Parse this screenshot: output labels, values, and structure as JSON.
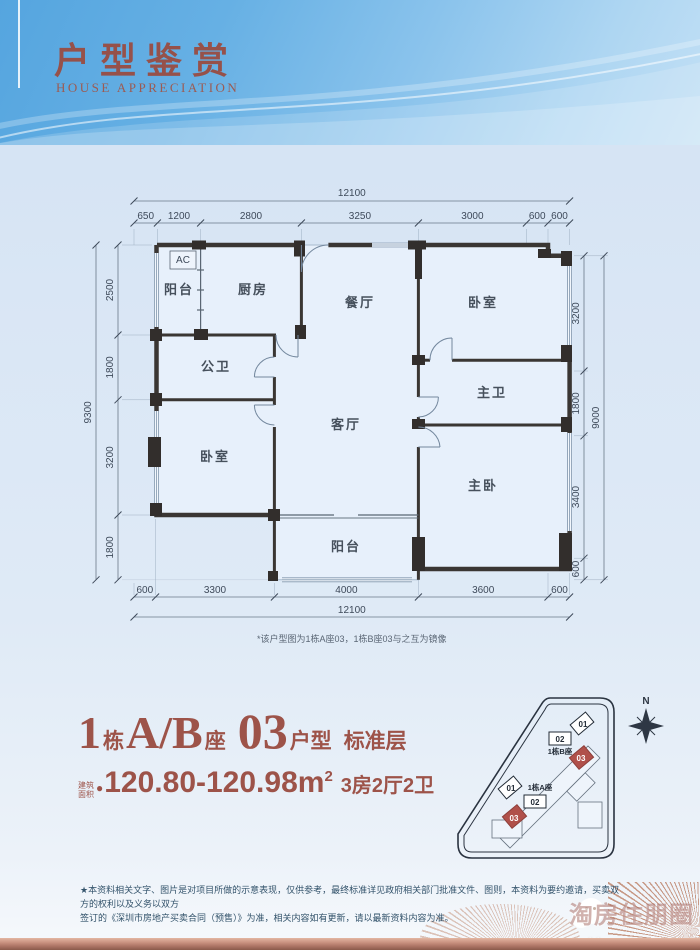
{
  "header": {
    "title": "户型鉴赏",
    "subtitle": "HOUSE APPRECIATION"
  },
  "plan": {
    "note": "*该户型图为1栋A座03，1栋B座03与之互为镜像",
    "rooms": {
      "balcony_top": "阳台",
      "kitchen": "厨房",
      "dining": "餐厅",
      "bedroom_top": "卧室",
      "bath_public": "公卫",
      "bath_master": "主卫",
      "bedroom_left": "卧室",
      "living": "客厅",
      "bedroom_master": "主卧",
      "balcony_bottom": "阳台",
      "ac": "AC"
    },
    "dims": {
      "top_total": "12100",
      "top": [
        "650",
        "1200",
        "2800",
        "3250",
        "3000",
        "600",
        "600"
      ],
      "bottom": [
        "600",
        "3300",
        "4000",
        "3600",
        "600"
      ],
      "bottom_total": "12100",
      "left_total": "9300",
      "left": [
        "2500",
        "1800",
        "3200",
        "1800"
      ],
      "right": [
        "3200",
        "1800",
        "3400",
        "600"
      ],
      "right_total": "9000"
    }
  },
  "unit_info": {
    "building_num": "1",
    "dong": "栋",
    "block": "A/B",
    "zuo": "座",
    "unit": "03",
    "unit_type": "户型",
    "floor_type": "标准层",
    "area_label_1": "建筑",
    "area_label_2": "面积",
    "area_bullet": "●",
    "area_value": "120.80-120.98m",
    "area_sup": "2",
    "layout": "3房2厅2卫"
  },
  "site_plan": {
    "north": "N",
    "block_b_label": "1栋B座",
    "block_a_label": "1栋A座",
    "b_units": [
      "01",
      "02",
      "03"
    ],
    "a_units": [
      "01",
      "02",
      "03"
    ]
  },
  "footer": {
    "disclaimer_line1": "★本资料相关文字、图片是对项目所做的示意表现，仅供参考，最终标准详见政府相关部门批准文件、图则，本资料为要约邀请，买卖双方的权利以及义务以双方",
    "disclaimer_line2": "签订的《深圳市房地产买卖合同（预售）》为准，相关内容如有更新，请以最新资料内容为准。",
    "watermark_cn": "淘房住朋圈",
    "watermark_url": "bbs.szhome.com"
  },
  "colors": {
    "accent": "#9d5349",
    "wall": "#3a3633",
    "red_unit": "#b0504a",
    "rosegold": "#c08775",
    "sky": "#66b0e4"
  }
}
